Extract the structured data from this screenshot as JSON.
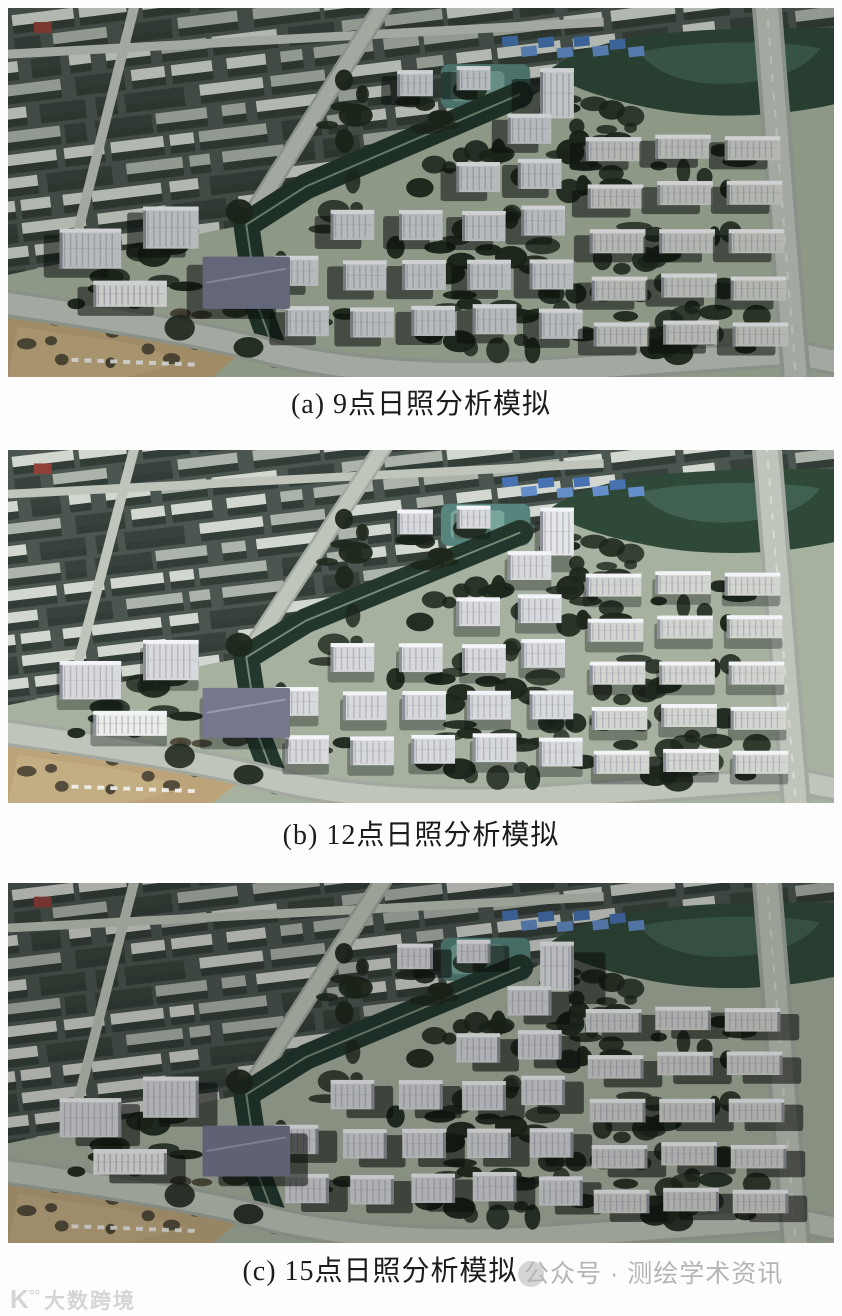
{
  "page": {
    "background": "#fdfdfd"
  },
  "figure": {
    "panels": [
      {
        "id": "a",
        "caption": "(a) 9点日照分析模拟",
        "sun": {
          "dx": -16,
          "dy": 6,
          "shadow_alpha": 0.55,
          "ambient": 0.1,
          "brightness": 1.0
        }
      },
      {
        "id": "b",
        "caption": "(b) 12点日照分析模拟",
        "sun": {
          "dx": -3,
          "dy": 8,
          "shadow_alpha": 0.34,
          "ambient": 0.0,
          "brightness": 1.06
        }
      },
      {
        "id": "c",
        "caption": "(c) 15点日照分析模拟",
        "sun": {
          "dx": 16,
          "dy": 6,
          "shadow_alpha": 0.58,
          "ambient": 0.13,
          "brightness": 0.98
        }
      }
    ],
    "scene_colors": {
      "ground": "#9ca795",
      "bg_city": "#47514b",
      "bg_roof1": "#c6cbc3",
      "bg_roof2": "#a2a9a0",
      "bg_dark": "#343e38",
      "bg_gap": "#2c3630",
      "road": "#b5bab0",
      "road_edge": "#99a096",
      "road_center": "#dde0d8",
      "red_roof": "#8d3b34",
      "park": "#2b4534",
      "pond": "#3a5c4c",
      "pool": "#4e7e76",
      "pool_light": "#6f9d92",
      "blue1": "#5b87c4",
      "blue2": "#3f6cae",
      "belt": "#20342a",
      "belt_path": "#93a68e",
      "dirt": "#b39a6f",
      "dirt_light": "#c2ab80",
      "speck": "#453f30",
      "tree": "#1b2519",
      "bld": "#cbcdd1",
      "bld_light": "#d6d8db",
      "bld_side": "#85888f",
      "bld_stripe": "#979ca4",
      "bld_roof": "#e5e6e9",
      "town": "#c7c9c5",
      "purple": "#6f7089",
      "purple_ridge": "#9a9bb4",
      "white": "#dfe1de",
      "shadow": "#0a0f0b",
      "car": "#e6e6e6",
      "ambient": "#0c120e"
    }
  },
  "watermarks": {
    "bottom_left": {
      "logo": "K",
      "logo_marks": "°°",
      "text": "大数跨境",
      "color": "#d5d5d5"
    },
    "bottom_right": {
      "text": "公众号 · 测绘学术资讯",
      "color": "#b5b5b5"
    }
  }
}
